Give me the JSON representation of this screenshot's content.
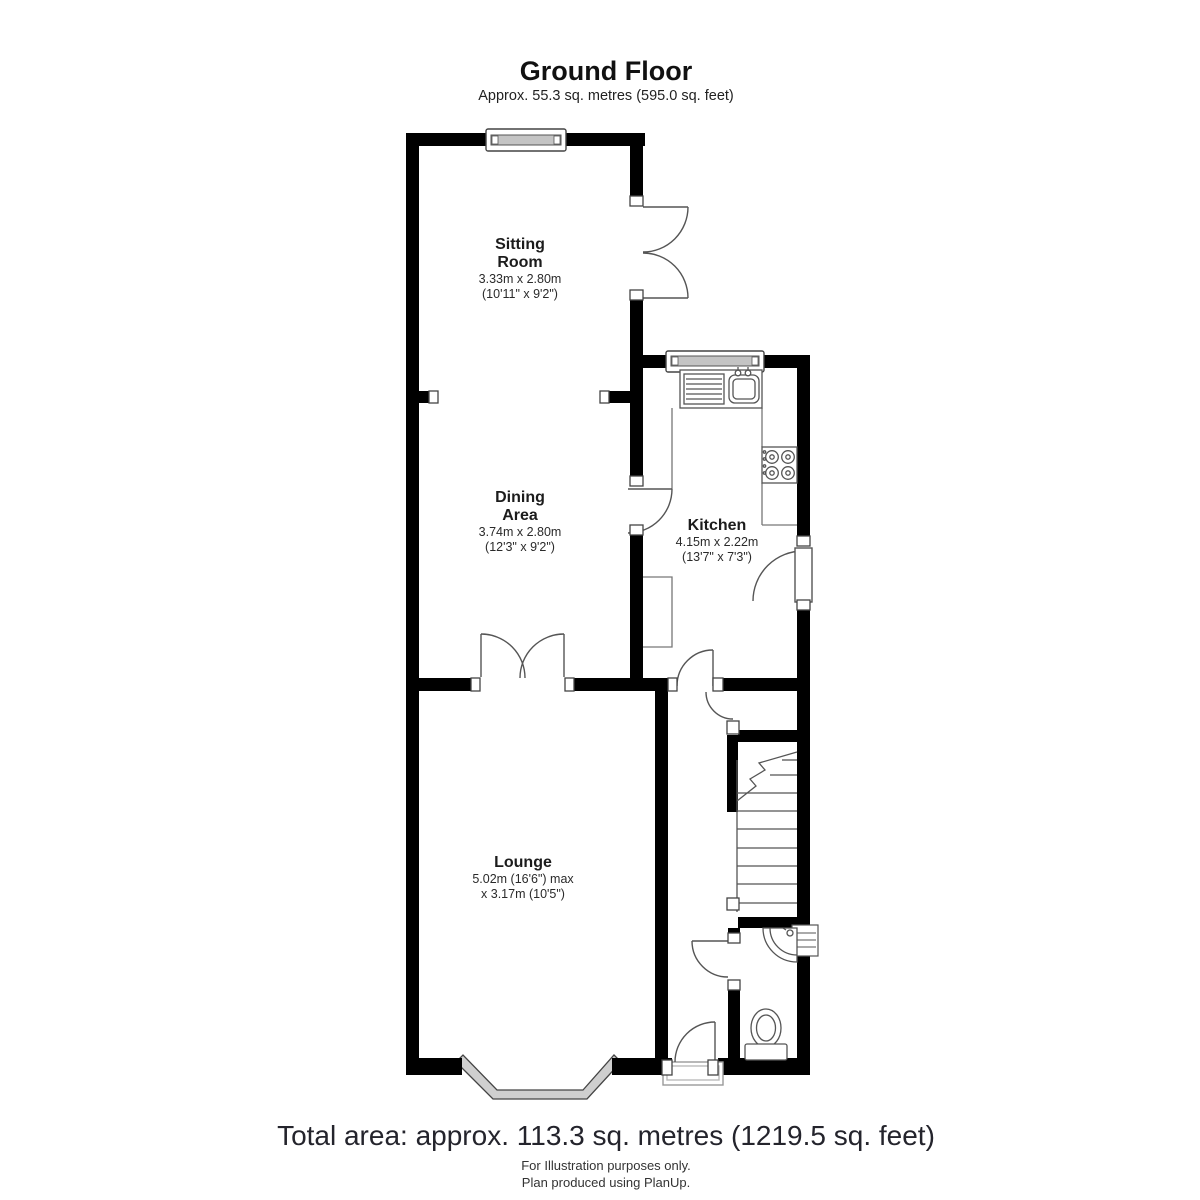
{
  "header": {
    "title": "Ground Floor",
    "subtitle": "Approx. 55.3 sq. metres (595.0 sq. feet)"
  },
  "rooms": [
    {
      "name": "Sitting\nRoom",
      "dims_metric": "3.33m x 2.80m",
      "dims_imperial": "(10'11\" x 9'2\")"
    },
    {
      "name": "Dining\nArea",
      "dims_metric": "3.74m x 2.80m",
      "dims_imperial": "(12'3\" x 9'2\")"
    },
    {
      "name": "Kitchen",
      "dims_metric": "4.15m x 2.22m",
      "dims_imperial": "(13'7\" x 7'3\")"
    },
    {
      "name": "Lounge",
      "dims_metric": "5.02m (16'6\") max",
      "dims_imperial": "x 3.17m (10'5\")"
    }
  ],
  "footer": {
    "total_area": "Total area: approx. 113.3 sq. metres (1219.5 sq. feet)",
    "line1": "For Illustration purposes only.",
    "line2": "Plan produced using PlanUp."
  },
  "colors": {
    "wall": "#000000",
    "fixture_line": "#555555",
    "window_fill": "#c4c4c4",
    "text": "#1c1c1c"
  }
}
